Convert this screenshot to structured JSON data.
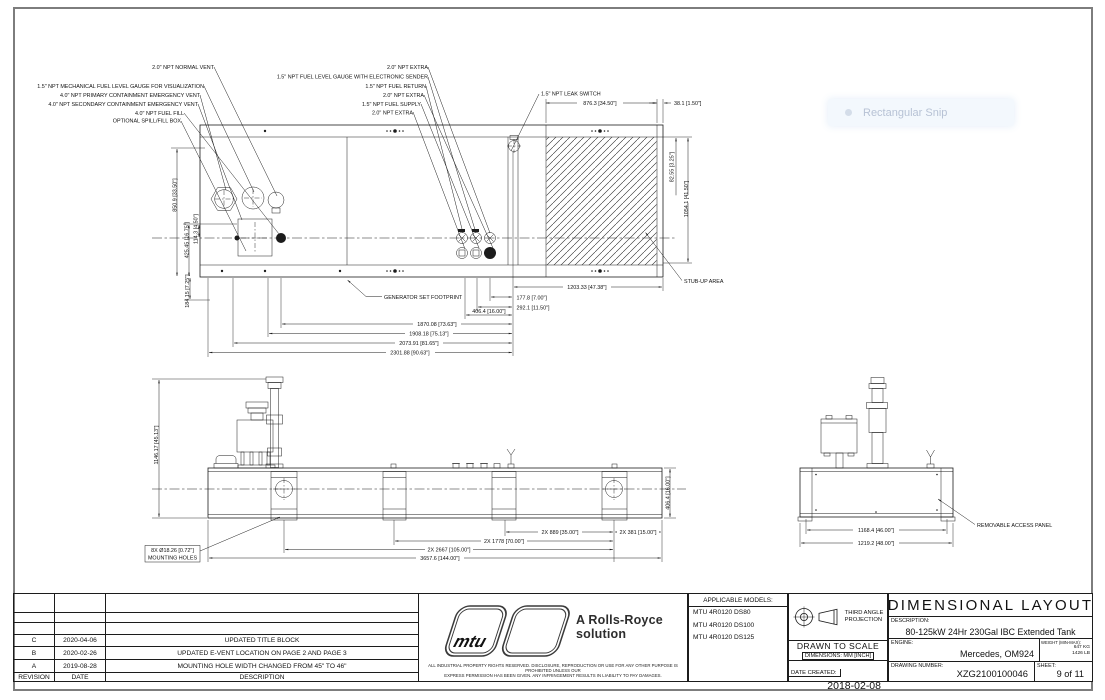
{
  "overlay": {
    "snip_label": "Rectangular Snip"
  },
  "top_view": {
    "callouts_left": [
      "2.0\" NPT NORMAL VENT",
      "1.5\" NPT MECHANICAL FUEL LEVEL GAUGE FOR VISUALIZATION",
      "4.0\" NPT PRIMARY CONTAINMENT EMERGENCY VENT",
      "4.0\" NPT SECONDARY CONTAINMENT EMERGENCY VENT",
      "4.0\" NPT FUEL FILL",
      "OPTIONAL SPILL/FILL BOX"
    ],
    "callouts_right": [
      "2.0\" NPT EXTRA",
      "1.5\" NPT FUEL LEVEL GAUGE WITH ELECTRONIC SENDER",
      "1.5\" NPT FUEL RETURN",
      "2.0\" NPT EXTRA",
      "1.5\" NPT FUEL SUPPLY",
      "2.0\" NPT EXTRA"
    ],
    "leak_switch_label": "1.5\" NPT LEAK SWITCH",
    "generator_footprint_label": "GENERATOR SET FOOTPRINT",
    "stub_up_label": "STUB-UP AREA",
    "dims": {
      "w876": "876.3 [34.50\"]",
      "w38": "38.1 [1.50\"]",
      "h82": "82.55 [3.25\"]",
      "h1054": "1054.1 [41.50\"]",
      "h850": "850.9 [33.50\"]",
      "h425": "425.45 [16.75\"]",
      "h114": "114.3 [4.50\"]",
      "h184": "184.15 [7.25\"]",
      "w1203": "1203.33 [47.38\"]",
      "w177": "177.8 [7.00\"]",
      "w292": "292.1 [11.50\"]",
      "w406": "406.4 [16.00\"]",
      "w1870": "1870.08 [73.63\"]",
      "w1908": "1908.18 [75.13\"]",
      "w2073": "2073.91 [81.65\"]",
      "w2301": "2301.88 [90.63\"]"
    }
  },
  "front_view": {
    "dims": {
      "h1146": "1146.17 [45.13\"]",
      "holes_line1": "8X Ø18.26 [0.72\"]",
      "holes_line2": "MOUNTING HOLES",
      "w889": "2X 889 [35.00\"]",
      "w381": "2X 381 [15.00\"]",
      "w1778": "2X 1778 [70.00\"]",
      "w2667": "2X 2667 [105.00\"]",
      "w3657": "3657.6 [144.00\"]",
      "h406": "406.4 [16.00\"]"
    }
  },
  "end_view": {
    "dims": {
      "w1168": "1168.4 [46.00\"]",
      "w1219": "1219.2 [48.00\"]"
    },
    "access_panel_label": "REMOVABLE ACCESS PANEL"
  },
  "title_block": {
    "revision_table": {
      "headers": {
        "revision": "REVISION",
        "date": "DATE",
        "description": "DESCRIPTION"
      },
      "rows": [
        {
          "rev": "C",
          "date": "2020-04-06",
          "desc": "UPDATED TITLE BLOCK"
        },
        {
          "rev": "B",
          "date": "2020-02-26",
          "desc": "UPDATED E-VENT LOCATION ON PAGE 2 AND PAGE 3"
        },
        {
          "rev": "A",
          "date": "2019-08-28",
          "desc": "MOUNTING HOLE WIDTH CHANGED FROM 45\" TO 46\""
        }
      ]
    },
    "brand": {
      "logo_text": "mtu",
      "tagline_line1": "A Rolls-Royce",
      "tagline_line2": "solution",
      "disclaimer_line1": "ALL INDUSTRIAL PROPERTY RIGHTS RESERVED. DISCLOSURE, REPRODUCTION OR USE FOR ANY OTHER PURPOSE IS PROHIBITED UNLESS OUR",
      "disclaimer_line2": "EXPRESS PERMISSION HAS BEEN GIVEN. ANY INFRINGEMENT RESULTS IN LIABILITY TO PAY DAMAGES."
    },
    "models": {
      "label": "APPLICABLE MODELS:",
      "items": [
        "MTU 4R0120 DS80",
        "MTU 4R0120 DS100",
        "MTU 4R0120 DS125"
      ]
    },
    "projection": {
      "line1": "THIRD ANGLE",
      "line2": "PROJECTION"
    },
    "scale": {
      "drawn": "DRAWN TO SCALE",
      "dimensions": "DIMENSIONS: MM [INCH]"
    },
    "date_created": {
      "label": "DATE CREATED:",
      "value": "2018-02-08"
    },
    "title": "DIMENSIONAL LAYOUT",
    "description": {
      "label": "DESCRIPTION:",
      "value": "80-125kW 24Hr 230Gal IBC Extended Tank"
    },
    "engine": {
      "label": "ENGINE:",
      "value": "Mercedes, OM924"
    },
    "weight": {
      "label": "WEIGHT (MIN-MAX):",
      "kg": "647 KG",
      "lb": "1426 LB"
    },
    "drawing_number": {
      "label": "DRAWING NUMBER:",
      "value": "XZG2100100046"
    },
    "sheet": {
      "label": "SHEET:",
      "value": "9 of 11"
    }
  }
}
